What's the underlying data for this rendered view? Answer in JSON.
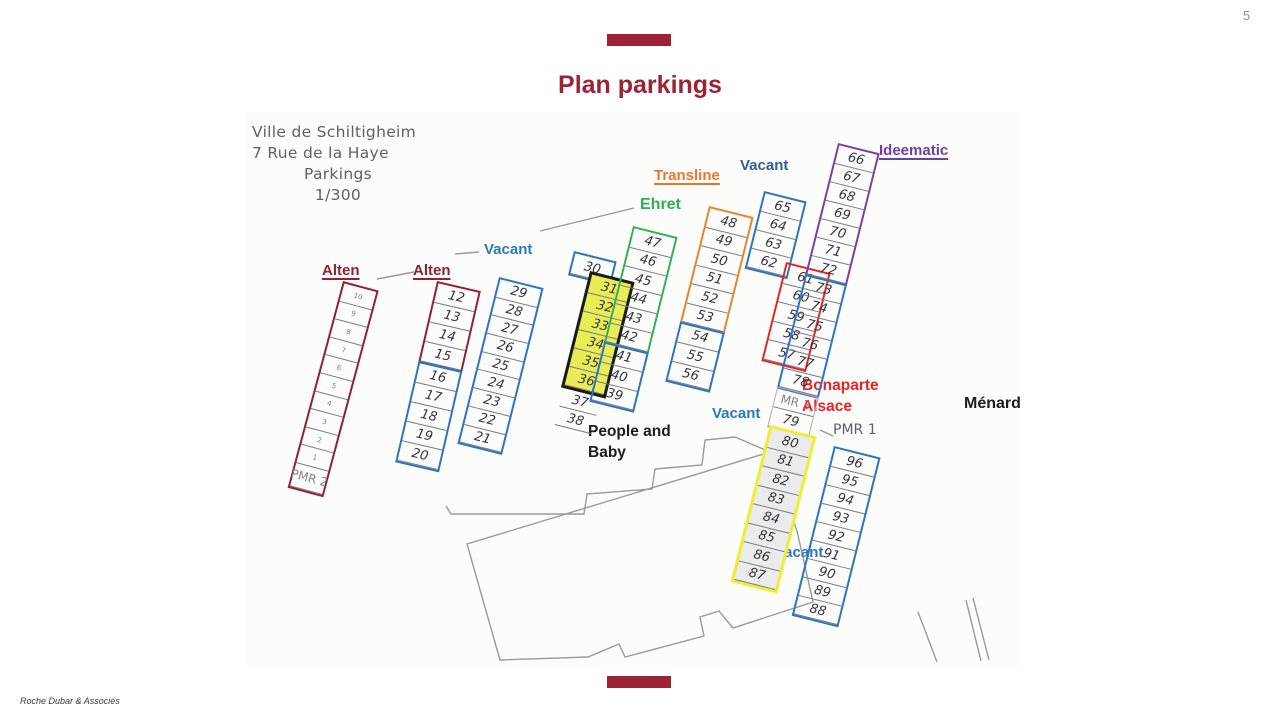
{
  "page": {
    "number": "5",
    "title": "Plan parkings",
    "footer": "Roche Dubar & Associés",
    "accent_color": "#9c2234"
  },
  "scan": {
    "header_lines": [
      "Ville de Schiltigheim",
      "7 Rue de la Haye",
      "Parkings",
      "1/300"
    ]
  },
  "labels": [
    {
      "id": "alten-1",
      "text": "Alten",
      "color": "#8e2233",
      "x": 322,
      "y": 261,
      "size": 15,
      "underline": true
    },
    {
      "id": "alten-2",
      "text": "Alten",
      "color": "#8e2233",
      "x": 413,
      "y": 261,
      "size": 15,
      "underline": true
    },
    {
      "id": "vacant-1",
      "text": "Vacant",
      "color": "#2b77c2",
      "x": 484,
      "y": 240,
      "size": 15,
      "underline": false
    },
    {
      "id": "ehret",
      "text": "Ehret",
      "color": "#2fae54",
      "x": 640,
      "y": 194,
      "size": 16,
      "underline": false
    },
    {
      "id": "transline",
      "text": "Transline",
      "color": "#e8762c",
      "x": 654,
      "y": 166,
      "size": 15,
      "underline": true
    },
    {
      "id": "vacant-2",
      "text": "Vacant",
      "color": "#33608f",
      "x": 740,
      "y": 156,
      "size": 15,
      "underline": false
    },
    {
      "id": "ideematic",
      "text": "Ideematic",
      "color": "#6f3fa3",
      "x": 879,
      "y": 141,
      "size": 15,
      "underline": true
    },
    {
      "id": "bonaparte-alsace",
      "text": "Bonaparte\nAlsace",
      "color": "#ee2127",
      "x": 802,
      "y": 376,
      "size": 15.5,
      "underline": false
    },
    {
      "id": "menard",
      "text": "Ménard",
      "color": "#1c1c1c",
      "x": 964,
      "y": 393,
      "size": 16,
      "underline": false
    },
    {
      "id": "people-and-baby",
      "text": "People and\nBaby",
      "color": "#1c1c1c",
      "x": 588,
      "y": 422,
      "size": 15.5,
      "underline": false
    },
    {
      "id": "vacant-3",
      "text": "Vacant",
      "color": "#2b77c2",
      "x": 712,
      "y": 404,
      "size": 15,
      "underline": false
    },
    {
      "id": "vacant-4",
      "text": "Vacant",
      "color": "#2b77c2",
      "x": 775,
      "y": 543,
      "size": 15,
      "underline": false
    },
    {
      "id": "pmr-1",
      "text": "PMR 1",
      "color": "#5f5f68",
      "x": 833,
      "y": 421,
      "size": 14,
      "underline": false,
      "printed": true
    }
  ],
  "columns": [
    {
      "id": "alten-row-1",
      "x": 343,
      "y": 281,
      "rot": 15,
      "w": 37,
      "ch": 18.6,
      "groups": [
        {
          "border": "#8e2233",
          "cells": [
            {
              "t": "10",
              "printed": true,
              "size": 7
            },
            {
              "t": "9",
              "printed": true,
              "size": 7
            },
            {
              "t": "8",
              "printed": true,
              "size": 7
            },
            {
              "t": "7",
              "printed": true,
              "size": 7
            },
            {
              "t": "6",
              "printed": true,
              "size": 7
            },
            {
              "t": "5",
              "printed": true,
              "size": 7
            },
            {
              "t": "4",
              "printed": true,
              "size": 7
            },
            {
              "t": "3",
              "printed": true,
              "size": 7
            },
            {
              "t": "2",
              "printed": true,
              "size": 7
            },
            {
              "t": "1",
              "printed": true,
              "size": 7
            },
            {
              "t": "PMR 2",
              "printed": true,
              "size": 12,
              "h": 24
            }
          ]
        }
      ]
    },
    {
      "id": "alten-row-2",
      "x": 437,
      "y": 281,
      "rot": 13,
      "w": 45,
      "ch": 20,
      "groups": [
        {
          "border": "#8e2233",
          "cells": [
            "12",
            "13",
            "14",
            "15"
          ]
        },
        {
          "border": "#2e74c0",
          "cells": [
            "16",
            "17",
            "18",
            "19",
            "20"
          ]
        }
      ]
    },
    {
      "id": "vacant-row",
      "x": 499,
      "y": 277,
      "rot": 14,
      "w": 46,
      "ch": 18.7,
      "groups": [
        {
          "border": "#2e74c0",
          "cells": [
            "29",
            "28",
            "27",
            "26",
            "25",
            "24",
            "23",
            "22",
            "21"
          ]
        }
      ]
    },
    {
      "id": "spot-30",
      "x": 574,
      "y": 251,
      "rot": 14,
      "w": 44,
      "ch": 21,
      "groups": [
        {
          "border": "#2e74c0",
          "cells": [
            "30"
          ]
        }
      ]
    },
    {
      "id": "people-baby-row",
      "x": 590,
      "y": 271,
      "rot": 14,
      "w": 46,
      "ch": 19,
      "groups": [
        {
          "border": "#1a1a1a",
          "bw": 3,
          "fill": "#e9ed55",
          "cells": [
            "31",
            "32",
            "33",
            "34",
            "35",
            "36"
          ]
        },
        {
          "border": "transparent",
          "bw": 1,
          "gw": 40,
          "ml": 2,
          "cells": [
            "37",
            "38"
          ]
        }
      ]
    },
    {
      "id": "ehret-row",
      "x": 633,
      "y": 226,
      "rot": 14,
      "w": 46,
      "ch": 19.5,
      "groups": [
        {
          "border": "#35b054",
          "cells": [
            "47",
            "46",
            "45",
            "44",
            "43",
            "42"
          ]
        },
        {
          "border": "#2e74c0",
          "cells": [
            "41",
            "40",
            "39"
          ]
        }
      ]
    },
    {
      "id": "transline-row",
      "x": 709,
      "y": 206,
      "rot": 14,
      "w": 46,
      "ch": 19.5,
      "groups": [
        {
          "border": "#e8852f",
          "cells": [
            "48",
            "49",
            "50",
            "51",
            "52",
            "53"
          ]
        },
        {
          "border": "#2e74c0",
          "cells": [
            "54",
            "55",
            "56"
          ]
        }
      ]
    },
    {
      "id": "vacant-65-row",
      "x": 764,
      "y": 191,
      "rot": 14,
      "w": 44,
      "ch": 19,
      "groups": [
        {
          "border": "#2e74c0",
          "cells": [
            "65",
            "64",
            "63",
            "62"
          ]
        }
      ]
    },
    {
      "id": "bonaparte-row",
      "x": 786,
      "y": 262,
      "rot": 14,
      "w": 46,
      "ch": 19.5,
      "groups": [
        {
          "border": "#e02728",
          "cells": [
            "61",
            "60",
            "59",
            "58",
            "57"
          ]
        }
      ]
    },
    {
      "id": "east-row",
      "x": 838,
      "y": 143,
      "rot": 14,
      "w": 43,
      "ch": 19,
      "groups": [
        {
          "border": "#7b3fa5",
          "cells": [
            "66",
            "67",
            "68",
            "69",
            "70",
            "71",
            "72"
          ]
        },
        {
          "border": "#2e74c0",
          "cells": [
            "73",
            "74",
            "75",
            "76",
            "77",
            "78"
          ]
        },
        {
          "border": "#b0b0b0",
          "bw": 1.4,
          "cells": [
            {
              "t": "MR 3",
              "printed": true,
              "size": 12,
              "h": 20
            },
            {
              "t": "79",
              "h": 20
            }
          ]
        },
        {
          "border": "#f0ee33",
          "bw": 3,
          "fill": "#ebebeb",
          "gw": 48,
          "ml": 2,
          "ch": 19.5,
          "cells": [
            "80",
            "81",
            "82",
            "83",
            "84",
            "85",
            "86",
            "87"
          ]
        }
      ]
    },
    {
      "id": "pmr1-row",
      "x": 834,
      "y": 446,
      "rot": 14,
      "w": 48,
      "ch": 19,
      "groups": [
        {
          "border": "#2e74c0",
          "cells": [
            "96",
            "95",
            "94",
            "93",
            "92",
            "91",
            "90",
            "89",
            "88"
          ]
        }
      ]
    }
  ],
  "outline_paths": [
    "M 446,506 L 451,514 L 584,514 L 587,494 L 652,489 L 655,469 L 702,465 L 705,440 L 735,437 L 770,452",
    "M 467,544 L 770,452 L 797,531 L 813,602 L 733,628 L 719,611 L 700,617 L 704,636 L 625,657 L 619,644 L 588,657 L 500,660 Z",
    "M 918,612 L 937,662",
    "M 966,600 L 981,661",
    "M 973,598 L 989,660",
    "M 377,279 L 414,272",
    "M 455,254 L 479,252",
    "M 540,231 L 634,208",
    "M 820,430 L 833,436"
  ]
}
